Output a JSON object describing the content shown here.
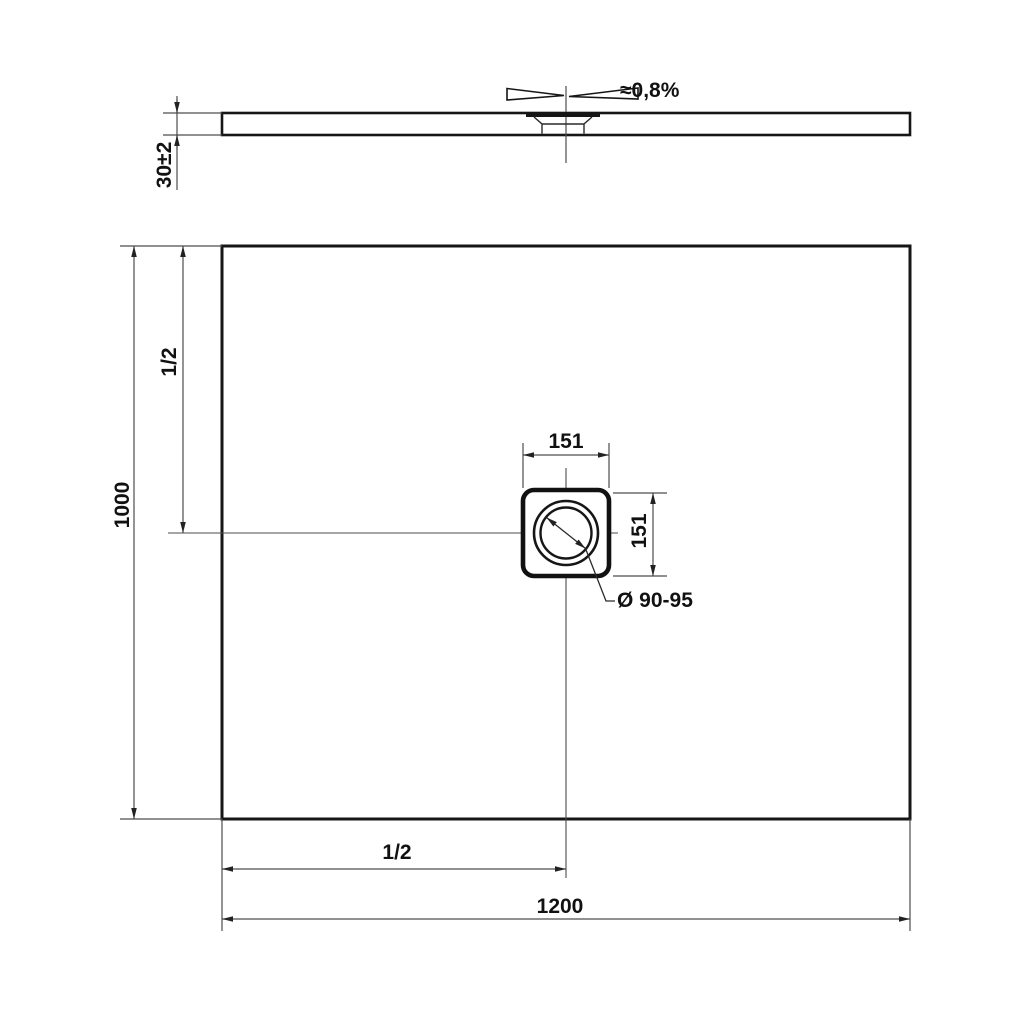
{
  "drawing_type": "technical-drawing-shower-tray",
  "side_view": {
    "slope_label": "≈0,8%",
    "thickness_label": "30±2"
  },
  "plan_view": {
    "height_label": "1000",
    "half_height_label": "1/2",
    "drain_width_label": "151",
    "drain_height_label": "151",
    "drain_diameter_label": "Ø 90-95",
    "half_width_label": "1/2",
    "width_label": "1200"
  },
  "colors": {
    "outline": "#161616",
    "dimension_line": "#4d4d4d",
    "text": "#111111",
    "background": "#ffffff"
  }
}
